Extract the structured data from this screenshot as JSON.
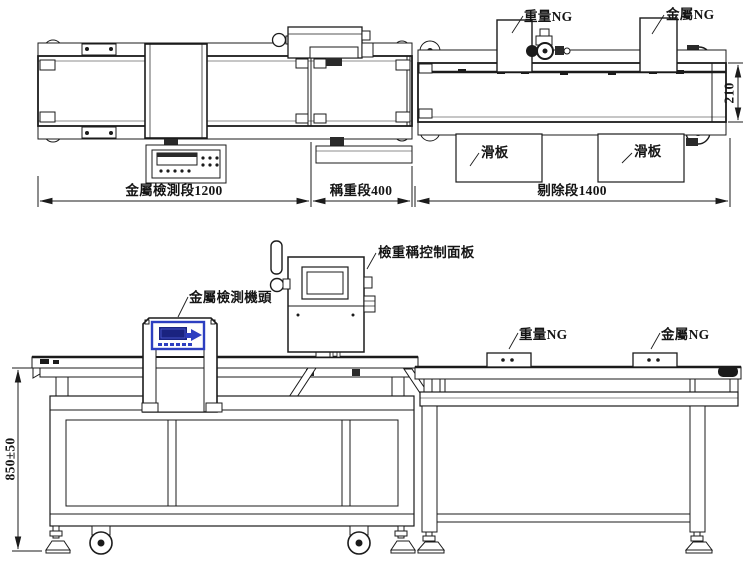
{
  "drawing": {
    "line_color": "#1b1b1b",
    "accent_blue": "#2c3ec0",
    "display_navy": "#1a2380",
    "background": "#ffffff"
  },
  "top_view": {
    "labels": {
      "weight_ng_flag": "重量NG",
      "metal_ng_flag": "金屬NG",
      "slide_plate_1": "滑板",
      "slide_plate_2": "滑板"
    },
    "dimensions": {
      "metal_detection_section": "金屬檢測段1200",
      "weighing_section": "稱重段400",
      "rejection_section": "剔除段1400",
      "belt_width": "210"
    }
  },
  "side_view": {
    "labels": {
      "checkweigher_panel": "檢重稱控制面板",
      "metal_detector_head": "金屬檢測機頭",
      "weight_ng": "重量NG",
      "metal_ng": "金屬NG"
    },
    "dimensions": {
      "table_height": "850±50"
    }
  }
}
